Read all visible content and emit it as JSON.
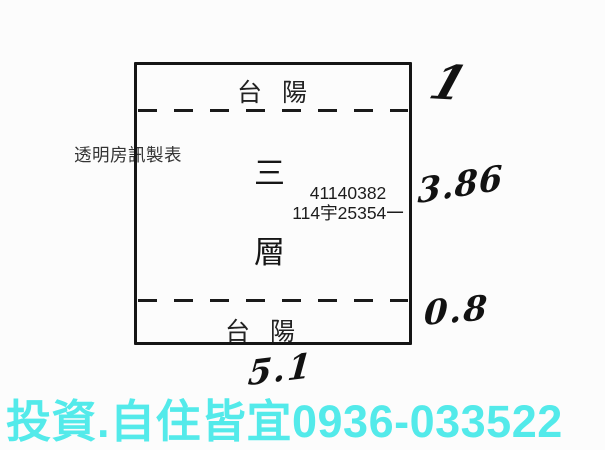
{
  "plan": {
    "balcony_top_label": "台 陽",
    "balcony_bottom_label": "台 陽",
    "floor_chars": [
      "三",
      "層"
    ],
    "registration_number": "41140382",
    "parcel_number": "114宇25354一"
  },
  "annotations": {
    "maker_watermark": "透明房訊製表",
    "dim_top_right": "1",
    "dim_right": "3.86",
    "dim_bottom_right": "0.8",
    "dim_bottom_width": "5.1"
  },
  "footer": {
    "ad_text": "投資.自住皆宜0936-033522",
    "ad_color": "#53eaea"
  },
  "colors": {
    "ink": "#151515",
    "background": "#fcfcfc"
  }
}
